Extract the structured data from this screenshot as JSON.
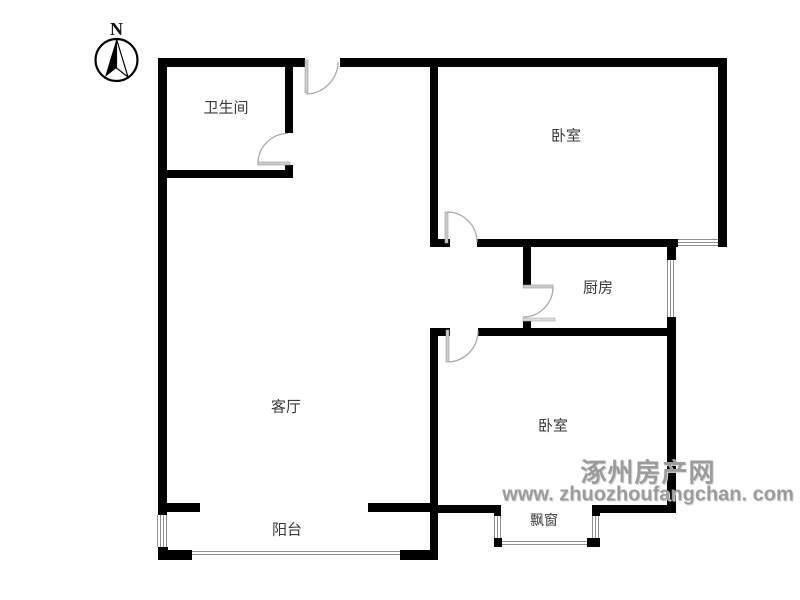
{
  "compass": {
    "label": "N"
  },
  "rooms": {
    "bathroom": "卫生间",
    "bedroom_top": "卧室",
    "kitchen": "厨房",
    "living_room": "客厅",
    "bedroom_bottom": "卧室",
    "balcony": "阳台",
    "bay_window": "飘窗"
  },
  "watermark": {
    "site_name": "涿州房产网",
    "site_url": "www. zhuozhoufangchan. com"
  },
  "colors": {
    "background": "#ffffff",
    "wall": "#000000",
    "window_line": "#8f8f8f",
    "door": "#b0b0b0",
    "label": "#3a3a3a",
    "watermark": "#9c9c9c"
  }
}
